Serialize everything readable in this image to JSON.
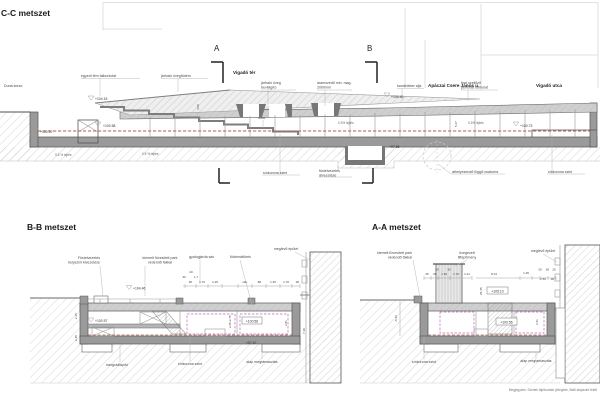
{
  "sheet": {
    "note": "Megjegyzés: Szintek tájékoztató jellegűek, Balti alapszint felett"
  },
  "colors": {
    "rail_dash": "#a8604f",
    "clearance_dash": "#c06ac0",
    "slab_gray": "#9a9a9a"
  },
  "cc": {
    "title": "C-C metszet",
    "marker_a": "A",
    "marker_b": "B",
    "streets": {
      "duna": "Duna korzó",
      "vigado_ter": "Vigadó tér",
      "apaczai": "Apáczai Csere János u.",
      "vigado_utca": "Vigadó utca"
    },
    "ann": {
      "metal_cladding": "egyedi fém falburkolat",
      "glass_deck": "járható üvegfödém",
      "glass_skylight_1": "járható üveg",
      "glass_skylight_2": "bevilágító",
      "pantograph_1": "áramszedő min. mag.",
      "pantograph_2": "2000mm",
      "lamp_base": "kandeláber alja",
      "perforated_1": "fent szellőző",
      "perforated_2": "perforált burkolat",
      "interior_small": "rézsű",
      "rail_level_left": "sínkorona szint",
      "smoke_duct_1": "füstelvezetés",
      "smoke_duct_2": "átvezetése",
      "hanging_duct": "áthelyezendő függő csatorna",
      "rail_level_right": "sínkorona szint"
    },
    "elev": {
      "e10415": "+104.15",
      "e10010": "+100.10",
      "e10058": "+100.58",
      "e10440": "+104.40",
      "e10073": "+100.73",
      "e9786": "+97.86"
    },
    "slope": {
      "s1": "0.5 % lejtés",
      "s2": "0.5 % lejtés",
      "s3": "0.3% lejtés",
      "s4": "0.3% lejtés"
    },
    "dim": {
      "d450": "4.50",
      "d547": "5.47"
    }
  },
  "bb": {
    "title": "B-B metszet",
    "ann": {
      "smoke_out_1": "Füstelvezetés",
      "smoke_out_2": "helyszíni kivezetése",
      "park_1": "kiemelt füvesített park",
      "park_2": "védendő fákkal",
      "walkway": "gyalogjárda sáv",
      "slab_opening": "födémáttörés",
      "existing_building": "meglévő épület",
      "silencer": "hangcsillapító",
      "rail_level": "sínkorona szint",
      "foundation": "alap megtámasztás"
    },
    "elev": {
      "e10446": "+104.46",
      "e10057": "+100.57",
      "e10056": "+100.56",
      "e9767": "+97.67"
    },
    "dim": {
      "row": [
        ".30",
        "1.70",
        "1.25",
        "vált.",
        ".80",
        "1.25",
        "1.70",
        ".30"
      ],
      "c20": "20",
      "c30": "30",
      "c17": "1.7",
      "v215": "2.15",
      "v248": "2.48",
      "v265": "2.65-2.75",
      "v281": "2.81",
      "v740": "7.40"
    }
  },
  "aa": {
    "title": "A-A metszet",
    "ann": {
      "park_1": "kiemelt füvesített park",
      "park_2": "védendő fákkal",
      "glazed_1": "üvegezett",
      "glazed_2": "liftépítmény",
      "existing_building": "meglévő épület",
      "rail_level": "sínkorona szint",
      "foundation": "alap megtámasztás"
    },
    "elev": {
      "e10510": "+105.10",
      "e10056": "+100.56"
    },
    "dim": {
      "row_left": [
        "25",
        ".50",
        "1.39",
        "1.70",
        "1.21"
      ],
      "c50": "50",
      "c30": "30",
      "d824": "8.24",
      "d125": "1.25",
      "right_top": [
        "20",
        ".50",
        "25"
      ],
      "right_bot": [
        "1.50",
        ".30"
      ],
      "v546": "-5.46",
      "v2535": "25-35",
      "v261": "2.61"
    }
  }
}
